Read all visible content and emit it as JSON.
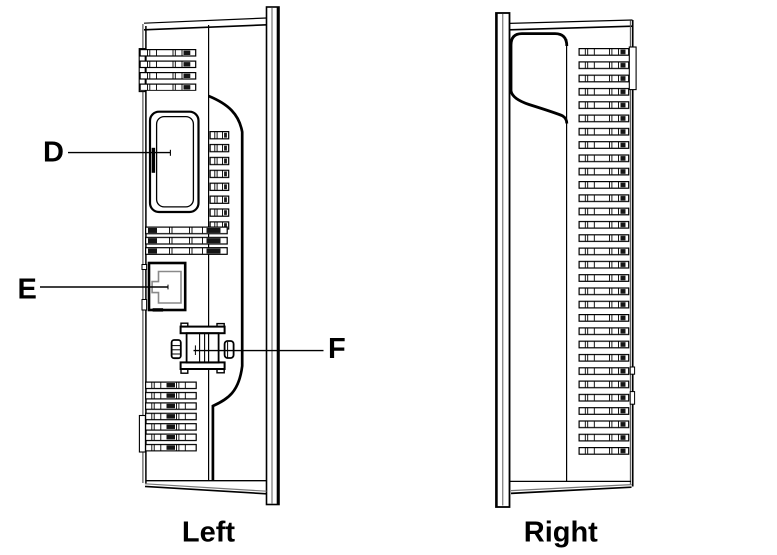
{
  "canvas": {
    "background": "#ffffff",
    "line_color": "#000000",
    "gray_line_color": "#8a8a8a"
  },
  "views": {
    "left": {
      "caption": "Left",
      "callouts": [
        {
          "label": "D",
          "target": "card-slot-cover"
        },
        {
          "label": "E",
          "target": "ethernet-port"
        },
        {
          "label": "F",
          "target": "usb-connector"
        }
      ]
    },
    "right": {
      "caption": "Right",
      "callouts": []
    }
  }
}
